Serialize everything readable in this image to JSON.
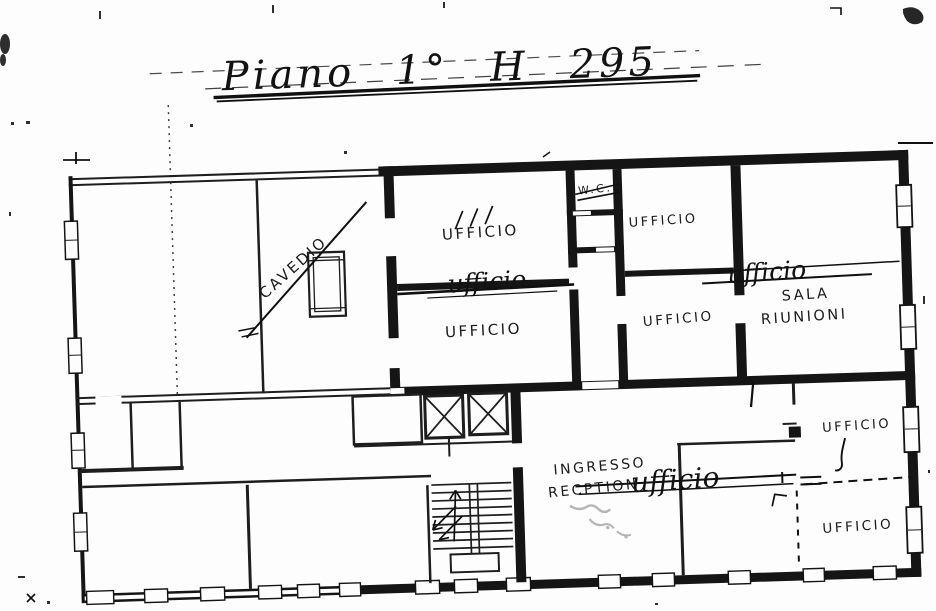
{
  "document": {
    "title": "Piano 1°  H 295"
  },
  "rooms": {
    "cavedio": "CAVEDIO",
    "wc": "W.C.",
    "office_mid_upper": "UFFICIO",
    "office_mid_lower": "UFFICIO",
    "office_right_col_upper": "UFFICIO",
    "office_right_col_lower": "UFFICIO",
    "meeting_room_line1": "SALA",
    "meeting_room_line2": "RIUNIONI",
    "entrance_line1": "INGRESSO",
    "entrance_line2": "RECPTION",
    "office_se_upper": "UFFICIO",
    "office_se_lower": "UFFICIO"
  },
  "handwritten_annotations": {
    "script_office_1": "ufficio",
    "script_office_2": "ufficio",
    "script_office_3": "ufficio"
  },
  "colors": {
    "ink": "#1c1c1c",
    "pen": "#101010",
    "pencil": "#b5b5b5",
    "paper": "#fdfdfd"
  }
}
